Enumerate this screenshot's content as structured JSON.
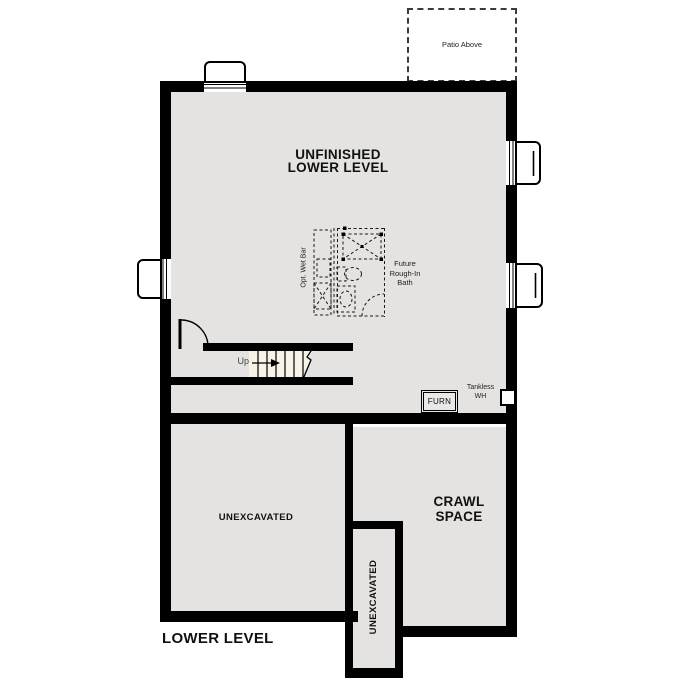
{
  "plan": {
    "patio_label": "Patio Above",
    "main_room": {
      "line1": "UNFINISHED",
      "line2": "LOWER LEVEL"
    },
    "wet_bar_label": "Opt. Wet Bar",
    "future_bath": {
      "line1": "Future",
      "line2": "Rough-In",
      "line3": "Bath"
    },
    "stairs": {
      "up_label": "Up"
    },
    "furnace_label": "FURN",
    "tankless": {
      "line1": "Tankless",
      "line2": "WH"
    },
    "unexcavated_left_label": "UNEXCAVATED",
    "unexcavated_strip_label": "UNEXCAVATED",
    "crawl_space": {
      "line1": "CRAWL",
      "line2": "SPACE"
    },
    "title": "LOWER LEVEL",
    "colors": {
      "wall": "#000000",
      "room_fill": "#e4e3e1",
      "stairs_fill": "#f8f3e7",
      "background": "#ffffff",
      "dashed_line": "#1a1a1a"
    }
  }
}
